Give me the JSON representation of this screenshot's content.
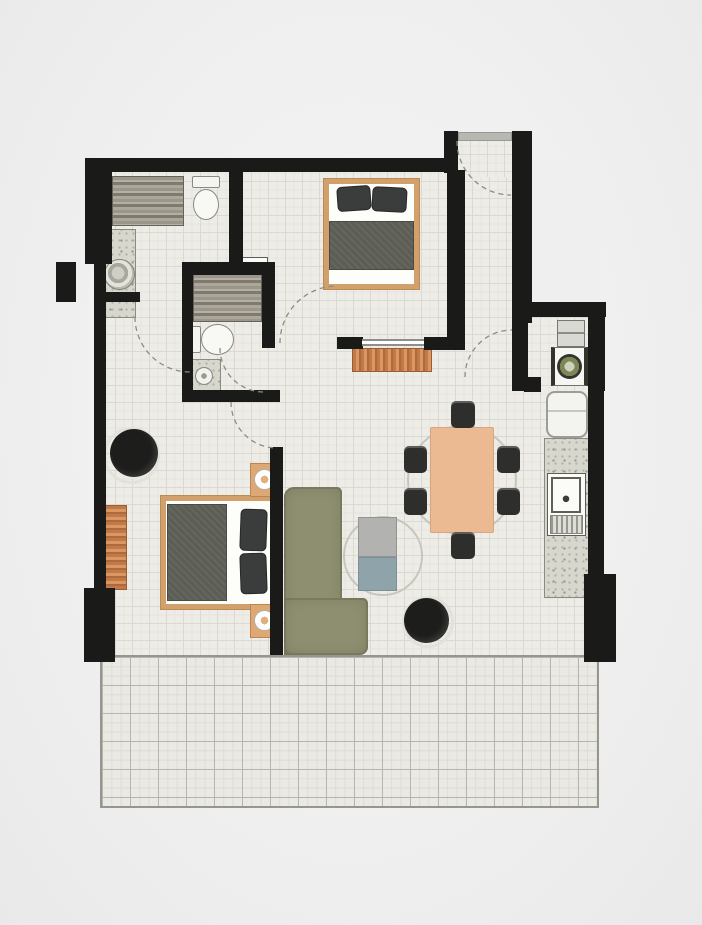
{
  "palette": {
    "wall": "#1a1a18",
    "floor_tile": "#edece6",
    "balcony_tile": "#eae9e3",
    "wood_frame": "#d2a06b",
    "wood_dresser": "#c2794a",
    "sofa_olive": "#8e8f70",
    "duvet_grey": "#5c5d55",
    "dining_table_tan": "#ecba92",
    "chair_black": "#2e2f2d",
    "coffee_table_blue_grey": "#8ea4aa",
    "washer_door_green": "#7d8657",
    "page_background": "#efefef"
  },
  "rooms": [
    {
      "name": "bedroom-1"
    },
    {
      "name": "bedroom-2"
    },
    {
      "name": "bathroom-1"
    },
    {
      "name": "bathroom-2"
    },
    {
      "name": "entry-hall"
    },
    {
      "name": "utility-closet"
    },
    {
      "name": "kitchen"
    },
    {
      "name": "living-dining-area"
    },
    {
      "name": "balcony"
    }
  ],
  "elements": [
    {
      "name": "main-floor",
      "cls": "floor",
      "x": 98,
      "y": 164,
      "w": 500,
      "h": 492
    },
    {
      "name": "entry-hall-floor",
      "cls": "floor",
      "x": 453,
      "y": 137,
      "w": 60,
      "h": 40
    },
    {
      "name": "notch-cover",
      "cls": "cover",
      "x": 531,
      "y": 160,
      "w": 69,
      "h": 146
    },
    {
      "name": "balcony-floor",
      "cls": "balcony",
      "x": 100,
      "y": 655,
      "w": 499,
      "h": 153
    },
    {
      "name": "dining-rug",
      "cls": "rug-ring",
      "x": 407,
      "y": 425,
      "w": 110,
      "h": 110
    },
    {
      "name": "coffee-table-rug",
      "cls": "rug-ring",
      "x": 343,
      "y": 516,
      "w": 80,
      "h": 80
    },
    {
      "name": "bathroom1-vanity",
      "cls": "vanity-wood",
      "x": 112,
      "y": 176,
      "w": 72,
      "h": 50
    },
    {
      "name": "bathroom1-toilet-tank",
      "cls": "toilet-tank",
      "x": 192,
      "y": 176,
      "w": 28,
      "h": 12
    },
    {
      "name": "bathroom1-toilet-bowl",
      "cls": "toilet-bowl",
      "x": 193,
      "y": 189,
      "w": 26,
      "h": 31
    },
    {
      "name": "bathroom1-sink-counter",
      "cls": "granite",
      "x": 101,
      "y": 229,
      "w": 35,
      "h": 64
    },
    {
      "name": "bathroom1-sink-basin",
      "cls": "basin",
      "x": 104,
      "y": 259,
      "w": 31,
      "h": 31
    },
    {
      "name": "bathroom1-lower-counter",
      "cls": "granite",
      "x": 101,
      "y": 298,
      "w": 35,
      "h": 20
    },
    {
      "name": "bathroom2-niche",
      "cls": "white-box",
      "x": 238,
      "y": 257,
      "w": 30,
      "h": 12
    },
    {
      "name": "bathroom2-vanity",
      "cls": "vanity-wood",
      "x": 193,
      "y": 274,
      "w": 69,
      "h": 48
    },
    {
      "name": "bathroom2-toilet-tank",
      "cls": "toilet-tank",
      "x": 190,
      "y": 326,
      "w": 11,
      "h": 27
    },
    {
      "name": "bathroom2-toilet-bowl",
      "cls": "toilet-bowl",
      "x": 201,
      "y": 324,
      "w": 33,
      "h": 31
    },
    {
      "name": "bathroom2-shower",
      "cls": "granite",
      "x": 188,
      "y": 359,
      "w": 33,
      "h": 34
    },
    {
      "name": "bathroom2-shower-drain",
      "cls": "drain",
      "x": 195,
      "y": 367,
      "w": 18,
      "h": 18
    },
    {
      "name": "utility-shelf",
      "cls": "shelf",
      "x": 557,
      "y": 320,
      "w": 28,
      "h": 27
    },
    {
      "name": "washing-machine",
      "cls": "washer",
      "x": 551,
      "y": 347,
      "w": 37,
      "h": 39
    },
    {
      "name": "washing-machine-door",
      "cls": "washer-door",
      "x": 557,
      "y": 354,
      "w": 25,
      "h": 25
    },
    {
      "name": "fridge",
      "cls": "fridge",
      "x": 546,
      "y": 391,
      "w": 42,
      "h": 47
    },
    {
      "name": "kitchen-counter",
      "cls": "granite",
      "x": 544,
      "y": 438,
      "w": 46,
      "h": 160
    },
    {
      "name": "kitchen-sink-unit",
      "cls": "white-box",
      "x": 547,
      "y": 473,
      "w": 39,
      "h": 63
    },
    {
      "name": "kitchen-sink",
      "cls": "ksink",
      "x": 551,
      "y": 477,
      "w": 30,
      "h": 36
    },
    {
      "name": "kitchen-drainer",
      "cls": "drainer",
      "x": 550,
      "y": 515,
      "w": 33,
      "h": 19
    },
    {
      "name": "bed1-frame",
      "cls": "bed-frame",
      "x": 324,
      "y": 179,
      "w": 95,
      "h": 110
    },
    {
      "name": "bed1-duvet",
      "cls": "duvet",
      "x": 329,
      "y": 221,
      "w": 85,
      "h": 49
    },
    {
      "name": "bed1-pillow-left",
      "cls": "pillow",
      "x": 337,
      "y": 186,
      "w": 34,
      "h": 25,
      "rot": -4
    },
    {
      "name": "bed1-pillow-right",
      "cls": "pillow",
      "x": 372,
      "y": 187,
      "w": 35,
      "h": 25,
      "rot": 3
    },
    {
      "name": "hallway-runner-rug",
      "cls": "wood-v",
      "x": 352,
      "y": 348,
      "w": 80,
      "h": 24
    },
    {
      "name": "bed2-frame",
      "cls": "bed-frame",
      "x": 161,
      "y": 496,
      "w": 117,
      "h": 113
    },
    {
      "name": "bed2-duvet",
      "cls": "duvet",
      "x": 167,
      "y": 504,
      "w": 60,
      "h": 97
    },
    {
      "name": "bed2-pillow-top",
      "cls": "pillow",
      "x": 240,
      "y": 509,
      "w": 27,
      "h": 42,
      "rot": 2
    },
    {
      "name": "bed2-pillow-bottom",
      "cls": "pillow",
      "x": 240,
      "y": 553,
      "w": 27,
      "h": 41,
      "rot": -2
    },
    {
      "name": "nightstand-top",
      "cls": "nightstand",
      "x": 250,
      "y": 463,
      "w": 29,
      "h": 34
    },
    {
      "name": "nightstand-lamp-top",
      "cls": "lamp",
      "x": 254,
      "y": 469,
      "w": 21,
      "h": 21
    },
    {
      "name": "nightstand-bottom",
      "cls": "nightstand",
      "x": 250,
      "y": 604,
      "w": 29,
      "h": 34
    },
    {
      "name": "nightstand-lamp-bottom",
      "cls": "lamp",
      "x": 254,
      "y": 610,
      "w": 21,
      "h": 21
    },
    {
      "name": "bedroom2-dresser",
      "cls": "wood-h",
      "x": 103,
      "y": 505,
      "w": 24,
      "h": 85
    },
    {
      "name": "bedroom2-chair-ring",
      "cls": "ring",
      "x": 103,
      "y": 427,
      "w": 57,
      "h": 57
    },
    {
      "name": "bedroom2-chair",
      "cls": "black-round",
      "x": 110,
      "y": 429,
      "w": 48,
      "h": 48
    },
    {
      "name": "sofa-back-section",
      "cls": "sofa sofa-v",
      "x": 284,
      "y": 487,
      "w": 58,
      "h": 168
    },
    {
      "name": "sofa-chaise-section",
      "cls": "sofa sofa-h",
      "x": 284,
      "y": 598,
      "w": 84,
      "h": 57
    },
    {
      "name": "coffee-table-top",
      "cls": "ctable-top",
      "x": 358,
      "y": 517,
      "w": 39,
      "h": 40
    },
    {
      "name": "coffee-table-bottom",
      "cls": "ctable-bottom",
      "x": 358,
      "y": 557,
      "w": 39,
      "h": 34
    },
    {
      "name": "pouf-ring",
      "cls": "ring",
      "x": 402,
      "y": 596,
      "w": 52,
      "h": 52
    },
    {
      "name": "pouf",
      "cls": "black-round",
      "x": 404,
      "y": 598,
      "w": 45,
      "h": 45
    },
    {
      "name": "dining-table",
      "cls": "dtable",
      "x": 430,
      "y": 427,
      "w": 64,
      "h": 106
    },
    {
      "name": "dining-chair-top",
      "cls": "chair",
      "x": 451,
      "y": 401,
      "w": 24,
      "h": 27
    },
    {
      "name": "dining-chair-bottom",
      "cls": "chair",
      "x": 451,
      "y": 532,
      "w": 24,
      "h": 27
    },
    {
      "name": "dining-chair-left-1",
      "cls": "chair",
      "x": 404,
      "y": 446,
      "w": 23,
      "h": 27
    },
    {
      "name": "dining-chair-left-2",
      "cls": "chair",
      "x": 404,
      "y": 488,
      "w": 23,
      "h": 27
    },
    {
      "name": "dining-chair-right-1",
      "cls": "chair",
      "x": 497,
      "y": 446,
      "w": 23,
      "h": 27
    },
    {
      "name": "dining-chair-right-2",
      "cls": "chair",
      "x": 497,
      "y": 488,
      "w": 23,
      "h": 27
    },
    {
      "name": "wall-top",
      "cls": "wall",
      "x": 85,
      "y": 158,
      "w": 367,
      "h": 14
    },
    {
      "name": "wall-entry-left-top",
      "cls": "wall",
      "x": 444,
      "y": 131,
      "w": 14,
      "h": 42
    },
    {
      "name": "entry-door-threshold",
      "cls": "threshold",
      "x": 458,
      "y": 132,
      "w": 54,
      "h": 9
    },
    {
      "name": "wall-entry-right",
      "cls": "wall",
      "x": 512,
      "y": 131,
      "w": 20,
      "h": 192
    },
    {
      "name": "wall-corridor-left",
      "cls": "wall",
      "x": 447,
      "y": 170,
      "w": 18,
      "h": 171
    },
    {
      "name": "wall-utility-top",
      "cls": "wall",
      "x": 517,
      "y": 302,
      "w": 89,
      "h": 15
    },
    {
      "name": "wall-utility-right",
      "cls": "wall",
      "x": 588,
      "y": 302,
      "w": 17,
      "h": 89
    },
    {
      "name": "wall-kitchen-right",
      "cls": "wall",
      "x": 588,
      "y": 391,
      "w": 16,
      "h": 186
    },
    {
      "name": "pillar-bottom-right",
      "cls": "wall",
      "x": 584,
      "y": 574,
      "w": 32,
      "h": 88
    },
    {
      "name": "wall-utility-left",
      "cls": "wall",
      "x": 512,
      "y": 322,
      "w": 16,
      "h": 69
    },
    {
      "name": "wall-utility-cap",
      "cls": "wall",
      "x": 524,
      "y": 377,
      "w": 17,
      "h": 15
    },
    {
      "name": "wall-left-upper",
      "cls": "wall",
      "x": 85,
      "y": 158,
      "w": 27,
      "h": 106
    },
    {
      "name": "wall-left-lower",
      "cls": "wall",
      "x": 94,
      "y": 262,
      "w": 12,
      "h": 330
    },
    {
      "name": "pillar-outer-left",
      "cls": "wall",
      "x": 56,
      "y": 262,
      "w": 20,
      "h": 40
    },
    {
      "name": "pillar-bottom-left",
      "cls": "wall",
      "x": 84,
      "y": 588,
      "w": 31,
      "h": 74
    },
    {
      "name": "wall-bathroom1-right",
      "cls": "wall",
      "x": 229,
      "y": 158,
      "w": 14,
      "h": 112
    },
    {
      "name": "wall-bathroom1-half",
      "cls": "wall",
      "x": 100,
      "y": 292,
      "w": 40,
      "h": 10
    },
    {
      "name": "wall-bathroom2-top",
      "cls": "wall",
      "x": 182,
      "y": 262,
      "w": 90,
      "h": 13
    },
    {
      "name": "wall-bathroom2-left",
      "cls": "wall",
      "x": 182,
      "y": 262,
      "w": 11,
      "h": 140
    },
    {
      "name": "wall-bathroom2-right",
      "cls": "wall",
      "x": 262,
      "y": 262,
      "w": 13,
      "h": 86
    },
    {
      "name": "wall-bathroom2-bottom",
      "cls": "wall",
      "x": 182,
      "y": 390,
      "w": 98,
      "h": 12
    },
    {
      "name": "wall-living-left",
      "cls": "wall",
      "x": 270,
      "y": 447,
      "w": 13,
      "h": 208
    },
    {
      "name": "wall-bedroom1-bottom-left-cap",
      "cls": "wall",
      "x": 337,
      "y": 337,
      "w": 26,
      "h": 12
    },
    {
      "name": "wall-bedroom1-bottom-right",
      "cls": "wall",
      "x": 424,
      "y": 337,
      "w": 41,
      "h": 13
    },
    {
      "name": "bedroom1-window-strip",
      "cls": "window-strip",
      "x": 362,
      "y": 339,
      "w": 62,
      "h": 7
    }
  ],
  "door_arcs": [
    {
      "name": "entry-door-swing",
      "d": "M 457,141 A 54,54 0 0 0 511,195"
    },
    {
      "name": "bathroom1-door-swing",
      "d": "M 135,317 A 55,55 0 0 0 190,372"
    },
    {
      "name": "bedroom1-door-swing",
      "d": "M 280,343 A 57,57 0 0 1 337,286"
    },
    {
      "name": "bathroom2-door-swing",
      "d": "M 220,348 A 44,44 0 0 0 264,392"
    },
    {
      "name": "bedroom2-door-swing",
      "d": "M 231,402 A 46,46 0 0 0 277,448"
    },
    {
      "name": "utility-door-swing",
      "d": "M 465,377 A 47,47 0 0 1 512,330"
    }
  ]
}
